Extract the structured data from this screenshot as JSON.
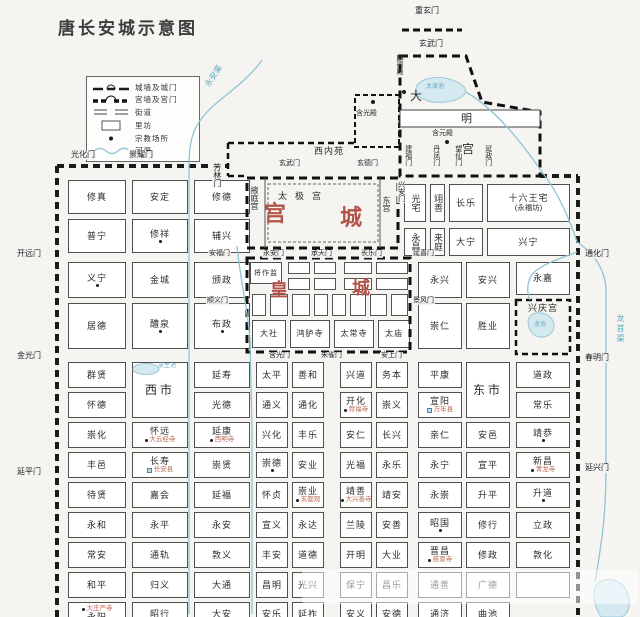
{
  "title": "唐长安城示意图",
  "colors": {
    "background": "#f5f4f1",
    "wall": "#1c1c1c",
    "water_line": "#8fc4d4",
    "water_fill": "#d5e9f0",
    "red_accent": "#b3544a",
    "blue_text": "#5fa8bf"
  },
  "legend": {
    "items": [
      {
        "label": "城墙及城门",
        "icon": "city-wall-icon"
      },
      {
        "label": "宫墙及宫门",
        "icon": "palace-wall-icon"
      },
      {
        "label": "街道",
        "icon": "street-icon"
      },
      {
        "label": "里坊",
        "icon": "ward-icon"
      },
      {
        "label": "宗教场所",
        "icon": "religious-site-icon"
      },
      {
        "label": "河渠",
        "icon": "river-icon"
      }
    ]
  },
  "wards": [
    {
      "l": "修真",
      "x": 68,
      "y": 180,
      "w": 58,
      "h": 34
    },
    {
      "l": "安定",
      "x": 132,
      "y": 180,
      "w": 56,
      "h": 34
    },
    {
      "l": "修德",
      "x": 194,
      "y": 180,
      "w": 56,
      "h": 34
    },
    {
      "l": "普宁",
      "x": 68,
      "y": 219,
      "w": 58,
      "h": 34
    },
    {
      "l": "修祥",
      "x": 132,
      "y": 219,
      "w": 56,
      "h": 34,
      "d": 1
    },
    {
      "l": "辅兴",
      "x": 194,
      "y": 219,
      "w": 56,
      "h": 34
    },
    {
      "l": "义宁",
      "x": 68,
      "y": 262,
      "w": 58,
      "h": 36,
      "d": 1
    },
    {
      "l": "金城",
      "x": 132,
      "y": 262,
      "w": 56,
      "h": 36
    },
    {
      "l": "颁政",
      "x": 194,
      "y": 262,
      "w": 56,
      "h": 36
    },
    {
      "l": "居德",
      "x": 68,
      "y": 303,
      "w": 58,
      "h": 46
    },
    {
      "l": "醴泉",
      "x": 132,
      "y": 303,
      "w": 56,
      "h": 46,
      "d": 1
    },
    {
      "l": "布政",
      "x": 194,
      "y": 303,
      "w": 56,
      "h": 46,
      "d": 1
    },
    {
      "l": "光宅",
      "x": 404,
      "y": 184,
      "w": 22,
      "h": 38,
      "v": 1
    },
    {
      "l": "翊善",
      "x": 430,
      "y": 184,
      "w": 15,
      "h": 38,
      "v": 1
    },
    {
      "l": "长乐",
      "x": 449,
      "y": 184,
      "w": 34,
      "h": 38
    },
    {
      "l": "十六王宅",
      "l2": "(永福坊)",
      "x": 487,
      "y": 184,
      "w": 83,
      "h": 38
    },
    {
      "l": "永昌",
      "x": 404,
      "y": 228,
      "w": 22,
      "h": 28,
      "v": 1
    },
    {
      "l": "来庭",
      "x": 430,
      "y": 228,
      "w": 15,
      "h": 28,
      "v": 1
    },
    {
      "l": "大宁",
      "x": 449,
      "y": 228,
      "w": 34,
      "h": 28
    },
    {
      "l": "兴宁",
      "x": 487,
      "y": 228,
      "w": 83,
      "h": 28
    },
    {
      "l": "永兴",
      "x": 418,
      "y": 262,
      "w": 44,
      "h": 36
    },
    {
      "l": "安兴",
      "x": 466,
      "y": 262,
      "w": 44,
      "h": 36
    },
    {
      "l": "永嘉",
      "x": 516,
      "y": 262,
      "w": 54,
      "h": 33
    },
    {
      "l": "崇仁",
      "x": 418,
      "y": 303,
      "w": 44,
      "h": 46
    },
    {
      "l": "胜业",
      "x": 466,
      "y": 303,
      "w": 44,
      "h": 46
    },
    {
      "l": "兴庆宫",
      "x": 516,
      "y": 300,
      "w": 54,
      "h": 54,
      "c": "noborder topalign",
      "n": "xingqing-palace"
    },
    {
      "l": "将作监",
      "x": 250,
      "y": 262,
      "w": 32,
      "h": 22,
      "c": "hc"
    },
    {
      "l": "大社",
      "x": 252,
      "y": 320,
      "w": 34,
      "h": 28,
      "c": "hc2"
    },
    {
      "l": "鸿胪寺",
      "x": 290,
      "y": 320,
      "w": 40,
      "h": 28,
      "c": "hc2"
    },
    {
      "l": "太常寺",
      "x": 334,
      "y": 320,
      "w": 40,
      "h": 28,
      "c": "hc2"
    },
    {
      "l": "太庙",
      "x": 378,
      "y": 320,
      "w": 32,
      "h": 28,
      "c": "hc2"
    },
    {
      "l": "群贤",
      "x": 68,
      "y": 362,
      "w": 58,
      "h": 26
    },
    {
      "l": "西市",
      "x": 132,
      "y": 362,
      "w": 56,
      "h": 56,
      "c": "mkt",
      "n": "west-market"
    },
    {
      "l": "延寿",
      "x": 194,
      "y": 362,
      "w": 56,
      "h": 26
    },
    {
      "l": "太平",
      "x": 256,
      "y": 362,
      "w": 32,
      "h": 26
    },
    {
      "l": "善和",
      "x": 292,
      "y": 362,
      "w": 32,
      "h": 26
    },
    {
      "l": "兴道",
      "x": 340,
      "y": 362,
      "w": 32,
      "h": 26
    },
    {
      "l": "务本",
      "x": 376,
      "y": 362,
      "w": 32,
      "h": 26
    },
    {
      "l": "平康",
      "x": 418,
      "y": 362,
      "w": 44,
      "h": 26
    },
    {
      "l": "东市",
      "x": 466,
      "y": 362,
      "w": 44,
      "h": 56,
      "c": "mkt",
      "n": "east-market"
    },
    {
      "l": "道政",
      "x": 516,
      "y": 362,
      "w": 54,
      "h": 26
    },
    {
      "l": "怀德",
      "x": 68,
      "y": 392,
      "w": 58,
      "h": 26
    },
    {
      "l": "光德",
      "x": 194,
      "y": 392,
      "w": 56,
      "h": 26
    },
    {
      "l": "通义",
      "x": 256,
      "y": 392,
      "w": 32,
      "h": 26
    },
    {
      "l": "通化",
      "x": 292,
      "y": 392,
      "w": 32,
      "h": 26
    },
    {
      "l": "开化",
      "x": 340,
      "y": 392,
      "w": 32,
      "h": 26,
      "d": 1,
      "s": "荐福寺"
    },
    {
      "l": "崇义",
      "x": 376,
      "y": 392,
      "w": 32,
      "h": 26
    },
    {
      "l": "宣阳",
      "x": 418,
      "y": 392,
      "w": 44,
      "h": 26,
      "q": 1,
      "s": "万年县"
    },
    {
      "l": "常乐",
      "x": 516,
      "y": 392,
      "w": 54,
      "h": 26
    },
    {
      "l": "崇化",
      "x": 68,
      "y": 422,
      "w": 58,
      "h": 26
    },
    {
      "l": "怀远",
      "x": 132,
      "y": 422,
      "w": 56,
      "h": 26,
      "d": 1,
      "s": "大云经寺"
    },
    {
      "l": "延康",
      "x": 194,
      "y": 422,
      "w": 56,
      "h": 26,
      "d": 1,
      "s": "西明寺"
    },
    {
      "l": "兴化",
      "x": 256,
      "y": 422,
      "w": 32,
      "h": 26
    },
    {
      "l": "丰乐",
      "x": 292,
      "y": 422,
      "w": 32,
      "h": 26
    },
    {
      "l": "安仁",
      "x": 340,
      "y": 422,
      "w": 32,
      "h": 26
    },
    {
      "l": "长兴",
      "x": 376,
      "y": 422,
      "w": 32,
      "h": 26
    },
    {
      "l": "亲仁",
      "x": 418,
      "y": 422,
      "w": 44,
      "h": 26
    },
    {
      "l": "安邑",
      "x": 466,
      "y": 422,
      "w": 44,
      "h": 26
    },
    {
      "l": "靖恭",
      "x": 516,
      "y": 422,
      "w": 54,
      "h": 26,
      "d": 1
    },
    {
      "l": "丰邑",
      "x": 68,
      "y": 452,
      "w": 58,
      "h": 26
    },
    {
      "l": "长寿",
      "x": 132,
      "y": 452,
      "w": 56,
      "h": 26,
      "q": 1,
      "s": "长安县"
    },
    {
      "l": "崇贤",
      "x": 194,
      "y": 452,
      "w": 56,
      "h": 26
    },
    {
      "l": "崇德",
      "x": 256,
      "y": 452,
      "w": 32,
      "h": 26,
      "d": 1
    },
    {
      "l": "安业",
      "x": 292,
      "y": 452,
      "w": 32,
      "h": 26
    },
    {
      "l": "光福",
      "x": 340,
      "y": 452,
      "w": 32,
      "h": 26
    },
    {
      "l": "永乐",
      "x": 376,
      "y": 452,
      "w": 32,
      "h": 26
    },
    {
      "l": "永宁",
      "x": 418,
      "y": 452,
      "w": 44,
      "h": 26
    },
    {
      "l": "宣平",
      "x": 466,
      "y": 452,
      "w": 44,
      "h": 26
    },
    {
      "l": "新昌",
      "x": 516,
      "y": 452,
      "w": 54,
      "h": 26,
      "d": 1,
      "s": "青龙寺"
    },
    {
      "l": "待贤",
      "x": 68,
      "y": 482,
      "w": 58,
      "h": 26
    },
    {
      "l": "嘉会",
      "x": 132,
      "y": 482,
      "w": 56,
      "h": 26
    },
    {
      "l": "延福",
      "x": 194,
      "y": 482,
      "w": 56,
      "h": 26
    },
    {
      "l": "怀贞",
      "x": 256,
      "y": 482,
      "w": 32,
      "h": 26
    },
    {
      "l": "崇业",
      "x": 292,
      "y": 482,
      "w": 32,
      "h": 26,
      "d": 1,
      "s": "玄都观"
    },
    {
      "l": "靖善",
      "x": 340,
      "y": 482,
      "w": 32,
      "h": 26,
      "d": 1,
      "s": "大兴善寺"
    },
    {
      "l": "靖安",
      "x": 376,
      "y": 482,
      "w": 32,
      "h": 26
    },
    {
      "l": "永崇",
      "x": 418,
      "y": 482,
      "w": 44,
      "h": 26
    },
    {
      "l": "升平",
      "x": 466,
      "y": 482,
      "w": 44,
      "h": 26
    },
    {
      "l": "升道",
      "x": 516,
      "y": 482,
      "w": 54,
      "h": 26,
      "d": 1
    },
    {
      "l": "永和",
      "x": 68,
      "y": 512,
      "w": 58,
      "h": 26
    },
    {
      "l": "永平",
      "x": 132,
      "y": 512,
      "w": 56,
      "h": 26
    },
    {
      "l": "永安",
      "x": 194,
      "y": 512,
      "w": 56,
      "h": 26
    },
    {
      "l": "宣义",
      "x": 256,
      "y": 512,
      "w": 32,
      "h": 26
    },
    {
      "l": "永达",
      "x": 292,
      "y": 512,
      "w": 32,
      "h": 26
    },
    {
      "l": "兰陵",
      "x": 340,
      "y": 512,
      "w": 32,
      "h": 26
    },
    {
      "l": "安善",
      "x": 376,
      "y": 512,
      "w": 32,
      "h": 26
    },
    {
      "l": "昭国",
      "x": 418,
      "y": 512,
      "w": 44,
      "h": 26,
      "d": 1
    },
    {
      "l": "修行",
      "x": 466,
      "y": 512,
      "w": 44,
      "h": 26
    },
    {
      "l": "立政",
      "x": 516,
      "y": 512,
      "w": 54,
      "h": 26
    },
    {
      "l": "常安",
      "x": 68,
      "y": 542,
      "w": 58,
      "h": 26
    },
    {
      "l": "通轨",
      "x": 132,
      "y": 542,
      "w": 56,
      "h": 26
    },
    {
      "l": "敦义",
      "x": 194,
      "y": 542,
      "w": 56,
      "h": 26
    },
    {
      "l": "丰安",
      "x": 256,
      "y": 542,
      "w": 32,
      "h": 26
    },
    {
      "l": "道德",
      "x": 292,
      "y": 542,
      "w": 32,
      "h": 26
    },
    {
      "l": "开明",
      "x": 340,
      "y": 542,
      "w": 32,
      "h": 26
    },
    {
      "l": "大业",
      "x": 376,
      "y": 542,
      "w": 32,
      "h": 26
    },
    {
      "l": "晋昌",
      "x": 418,
      "y": 542,
      "w": 44,
      "h": 26,
      "d": 1,
      "s": "慈恩寺"
    },
    {
      "l": "修政",
      "x": 466,
      "y": 542,
      "w": 44,
      "h": 26
    },
    {
      "l": "敦化",
      "x": 516,
      "y": 542,
      "w": 54,
      "h": 26
    },
    {
      "l": "和平",
      "x": 68,
      "y": 572,
      "w": 58,
      "h": 26
    },
    {
      "l": "归义",
      "x": 132,
      "y": 572,
      "w": 56,
      "h": 26
    },
    {
      "l": "大通",
      "x": 194,
      "y": 572,
      "w": 56,
      "h": 26
    },
    {
      "l": "昌明",
      "x": 256,
      "y": 572,
      "w": 32,
      "h": 26
    },
    {
      "l": "光兴",
      "x": 292,
      "y": 572,
      "w": 32,
      "h": 26
    },
    {
      "l": "保宁",
      "x": 340,
      "y": 572,
      "w": 32,
      "h": 26
    },
    {
      "l": "昌乐",
      "x": 376,
      "y": 572,
      "w": 32,
      "h": 26
    },
    {
      "l": "通善",
      "x": 418,
      "y": 572,
      "w": 44,
      "h": 26
    },
    {
      "l": "广德",
      "x": 466,
      "y": 572,
      "w": 44,
      "h": 26
    },
    {
      "l": "",
      "x": 516,
      "y": 572,
      "w": 54,
      "h": 26
    },
    {
      "l": "永阳",
      "x": 68,
      "y": 602,
      "w": 58,
      "h": 24,
      "d": 1,
      "s": "大庄严寺",
      "c": "subtop"
    },
    {
      "l": "昭行",
      "x": 132,
      "y": 602,
      "w": 56,
      "h": 24
    },
    {
      "l": "大安",
      "x": 194,
      "y": 602,
      "w": 56,
      "h": 24
    },
    {
      "l": "安乐",
      "x": 256,
      "y": 602,
      "w": 32,
      "h": 24
    },
    {
      "l": "延祚",
      "x": 292,
      "y": 602,
      "w": 32,
      "h": 24
    },
    {
      "l": "安义",
      "x": 340,
      "y": 602,
      "w": 32,
      "h": 24
    },
    {
      "l": "安德",
      "x": 376,
      "y": 602,
      "w": 32,
      "h": 24
    },
    {
      "l": "通济",
      "x": 418,
      "y": 602,
      "w": 44,
      "h": 24
    },
    {
      "l": "曲池",
      "x": 466,
      "y": 602,
      "w": 44,
      "h": 24
    }
  ],
  "imperial_cells": [
    [
      288,
      262,
      22,
      12
    ],
    [
      314,
      262,
      22,
      12
    ],
    [
      344,
      262,
      28,
      12
    ],
    [
      376,
      262,
      32,
      12
    ],
    [
      288,
      278,
      22,
      12
    ],
    [
      314,
      278,
      22,
      12
    ],
    [
      344,
      278,
      28,
      12
    ],
    [
      376,
      278,
      32,
      12
    ],
    [
      252,
      294,
      14,
      22
    ],
    [
      270,
      294,
      18,
      22
    ],
    [
      292,
      294,
      18,
      22
    ],
    [
      314,
      294,
      14,
      22
    ],
    [
      332,
      294,
      14,
      22
    ],
    [
      350,
      294,
      16,
      22
    ],
    [
      370,
      294,
      17,
      22
    ],
    [
      391,
      294,
      17,
      22
    ]
  ],
  "gates": [
    {
      "t": "光化门",
      "x": 70,
      "y": 151
    },
    {
      "t": "景耀门",
      "x": 128,
      "y": 151
    },
    {
      "t": "芳林门",
      "x": 212,
      "y": 162,
      "v": 1
    },
    {
      "t": "重玄门",
      "x": 414,
      "y": 7
    },
    {
      "t": "玄武门",
      "x": 418,
      "y": 40
    },
    {
      "t": "开远门",
      "x": 16,
      "y": 250
    },
    {
      "t": "金光门",
      "x": 16,
      "y": 352
    },
    {
      "t": "延平门",
      "x": 16,
      "y": 468
    },
    {
      "t": "通化门",
      "x": 584,
      "y": 250
    },
    {
      "t": "春明门",
      "x": 584,
      "y": 354
    },
    {
      "t": "延兴门",
      "x": 584,
      "y": 464
    },
    {
      "t": "玄武门",
      "x": 278,
      "y": 160,
      "s": 1
    },
    {
      "t": "玄德门",
      "x": 356,
      "y": 160,
      "s": 1
    },
    {
      "t": "兴安门",
      "x": 397,
      "y": 180,
      "v": 1,
      "s": 1
    },
    {
      "t": "建福门",
      "x": 404,
      "y": 144,
      "v": 1,
      "s": 1
    },
    {
      "t": "丹凤门",
      "x": 432,
      "y": 144,
      "v": 1,
      "s": 1
    },
    {
      "t": "望仙门",
      "x": 454,
      "y": 144,
      "v": 1,
      "s": 1
    },
    {
      "t": "延政门",
      "x": 484,
      "y": 144,
      "v": 1,
      "s": 1
    },
    {
      "t": "安福门",
      "x": 208,
      "y": 250,
      "s": 1
    },
    {
      "t": "顺义门",
      "x": 206,
      "y": 297,
      "s": 1
    },
    {
      "t": "延喜门",
      "x": 412,
      "y": 250,
      "s": 1
    },
    {
      "t": "景风门",
      "x": 412,
      "y": 297,
      "s": 1
    },
    {
      "t": "永安门",
      "x": 262,
      "y": 250,
      "s": 1
    },
    {
      "t": "承天门",
      "x": 310,
      "y": 250,
      "s": 1
    },
    {
      "t": "长乐门",
      "x": 360,
      "y": 250,
      "s": 1
    },
    {
      "t": "含光门",
      "x": 268,
      "y": 352,
      "s": 1
    },
    {
      "t": "朱雀门",
      "x": 320,
      "y": 352,
      "s": 1
    },
    {
      "t": "安上门",
      "x": 380,
      "y": 352,
      "s": 1
    }
  ],
  "labels": [
    {
      "t": "西内苑",
      "x": 314,
      "y": 147,
      "c": "sz9 ls1",
      "n": "west-inner-park-label"
    },
    {
      "t": "掖庭宫",
      "x": 250,
      "y": 186,
      "c": "sz8 v",
      "n": "yeting-palace-label"
    },
    {
      "t": "东宫",
      "x": 382,
      "y": 196,
      "c": "sz8 v",
      "n": "east-palace-label"
    },
    {
      "t": "太极宫",
      "x": 278,
      "y": 192,
      "c": "sz9 ls8",
      "n": "taiji-palace-label"
    },
    {
      "t": "宫",
      "x": 264,
      "y": 203,
      "c": "red sz22",
      "n": "palace-city-label"
    },
    {
      "t": "城",
      "x": 340,
      "y": 207,
      "c": "red sz22",
      "n": "palace-city-label"
    },
    {
      "t": "皇",
      "x": 270,
      "y": 281,
      "c": "red sz18",
      "n": "imperial-city-label"
    },
    {
      "t": "城",
      "x": 352,
      "y": 279,
      "c": "red sz18",
      "n": "imperial-city-label"
    },
    {
      "t": "大",
      "x": 410,
      "y": 90,
      "c": "sz12",
      "n": "daming-palace-label"
    },
    {
      "t": "明",
      "x": 461,
      "y": 114,
      "c": "sz11",
      "n": "daming-palace-label"
    },
    {
      "t": "宫",
      "x": 462,
      "y": 143,
      "c": "sz12",
      "n": "daming-palace-label"
    },
    {
      "t": "含元殿",
      "x": 432,
      "y": 130,
      "c": "sz7",
      "n": "hanyuan-hall-label"
    },
    {
      "t": "麟德殿",
      "x": 396,
      "y": 54,
      "c": "sz7 v",
      "n": "linde-hall-label"
    },
    {
      "t": "含光殿",
      "x": 356,
      "y": 110,
      "c": "sz7",
      "n": "hanguang-hall-label"
    },
    {
      "t": "太液池",
      "x": 426,
      "y": 84,
      "c": "blue sz6",
      "n": "taiye-pool-label"
    },
    {
      "t": "放生池",
      "x": 158,
      "y": 363,
      "c": "blue sz6",
      "n": "fangsheng-pond-label"
    },
    {
      "t": "龙池",
      "x": 534,
      "y": 322,
      "c": "blue sz6",
      "n": "dragon-pool-label"
    },
    {
      "t": "龙首渠",
      "x": 616,
      "y": 314,
      "c": "blue sz8 v ls2",
      "n": "longshou-canal-label"
    },
    {
      "t": "永安渠",
      "x": 204,
      "y": 84,
      "c": "blue sz8 rot",
      "n": "yongan-canal-label"
    }
  ],
  "religious_dots": [
    [
      402,
      90
    ],
    [
      445,
      140
    ],
    [
      371,
      100
    ]
  ],
  "watermark": true
}
